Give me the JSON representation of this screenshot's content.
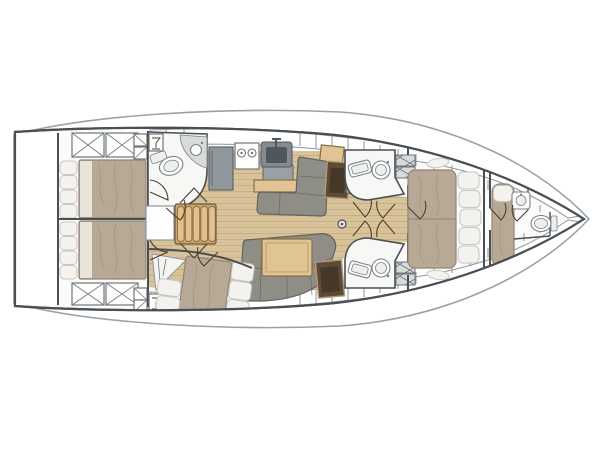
{
  "diagram": {
    "type": "sailboat-interior-floor-plan",
    "orientation": "bow-right",
    "background": "#ffffff"
  },
  "colors": {
    "page_bg": "#ffffff",
    "hull_line": "#4a4f54",
    "deck_line": "#9aa1a7",
    "wood": "#d9c39a",
    "wood_line": "#b2946a",
    "bed": "#b8a996",
    "bed_line": "#938374",
    "sheet": "#e9e4da",
    "pillow": "#f3f2ee",
    "pillow_line": "#c7c6c0",
    "sofa": "#8f8e86",
    "sofa_line": "#64635b",
    "table_wood": "#e0c493",
    "table_line": "#8a6f45",
    "counter": "#9aa0a5",
    "desk": "#5d4b3a",
    "desk_inner": "#463829",
    "room": "#f7f7f5",
    "fixture_line": "#7b828a",
    "locker_line": "#8f969b",
    "hatch_line": "#6f767c",
    "stair": "#e3c08e",
    "stair_line": "#8a6a42",
    "door": "#4a3f2f"
  },
  "features": [
    "transom-garage",
    "aft-cabin-port-double-berth",
    "aft-cabin-starboard-double-berth",
    "aft-head-toilet-and-sink",
    "companionway-stairs",
    "galley-fridge-stove-sink",
    "salon-l-settee-starboard",
    "salon-settee-port-with-table",
    "mid-cabin-berth",
    "nav-desk-starboard",
    "nav-desk-port",
    "forward-head-starboard",
    "forward-head-port",
    "mast-post",
    "forward-cabin-island-berth",
    "forepeak-berth",
    "forepeak-head-toilet-and-sink"
  ]
}
